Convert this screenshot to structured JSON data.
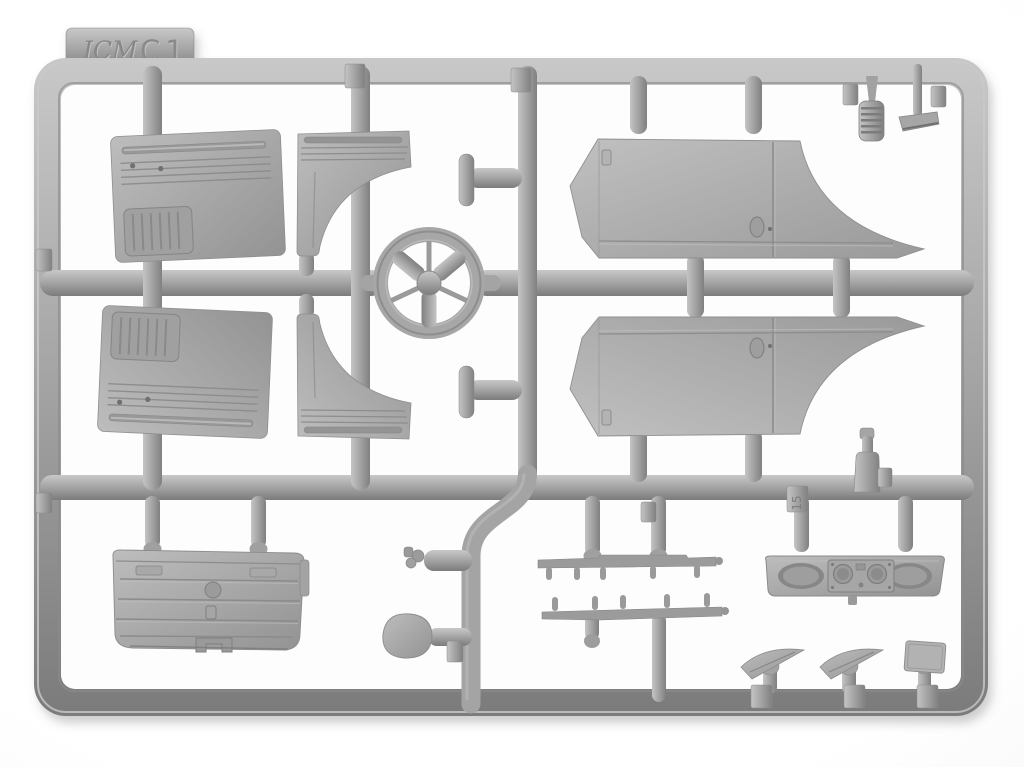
{
  "image": {
    "kind": "photograph",
    "subject": "Injection-molded gray styrene sprue (parts frame) from an ICM scale model kit, photographed on a white background"
  },
  "sprue": {
    "brand": "ICM",
    "code": "C1",
    "tab_number_15": "15",
    "colors": {
      "plastic_base": "#a7a7a7",
      "plastic_light": "#c8c8c8",
      "plastic_dark": "#7b7b7b",
      "background": "#ffffff"
    },
    "parts": [
      {
        "name": "door-inner-panel-upper",
        "appearance": "rectangular panel, horizontal ribs, louvered pocket, two small holes"
      },
      {
        "name": "door-inner-panel-lower",
        "appearance": "mirrored copy of the upper door panel"
      },
      {
        "name": "quarter-panel-upper",
        "appearance": "ribbed bracket with concave wheel-arch cutout"
      },
      {
        "name": "quarter-panel-lower",
        "appearance": "mirrored copy of the upper quarter panel"
      },
      {
        "name": "steering-wheel",
        "appearance": "three thick spokes and three thin spokes around a round hub"
      },
      {
        "name": "cab-side-panel-upper",
        "appearance": "long body side with pointed nose, door seam, oval handle recess and swept wheel-arch tail"
      },
      {
        "name": "cab-side-panel-lower",
        "appearance": "mirrored copy of the upper body side panel"
      },
      {
        "name": "rear-cab-panel",
        "appearance": "wide ribbed panel with filler cap, latch and bracket details"
      },
      {
        "name": "dashboard",
        "appearance": "instrument panel with two oval bezels and twin round gauges"
      },
      {
        "name": "hinge-rail-upper",
        "appearance": "thin stepped rail with five pegs"
      },
      {
        "name": "hinge-rail-lower",
        "appearance": "thin stepped rail with five pegs"
      },
      {
        "name": "rear-view-mirror",
        "appearance": "oval paddle mirror on a short arm"
      },
      {
        "name": "horn",
        "appearance": "small cylinder with detailed tip"
      },
      {
        "name": "hand-lever-upper",
        "appearance": "T-shaped lever"
      },
      {
        "name": "hand-lever-lower",
        "appearance": "T-shaped lever"
      },
      {
        "name": "gear-lever-base",
        "appearance": "bottle-shaped boot with cap"
      },
      {
        "name": "spring",
        "appearance": "ribbed coil spring"
      },
      {
        "name": "pedal",
        "appearance": "flat blade on a stem"
      },
      {
        "name": "wiper-blade-left",
        "appearance": "slender tapered blade on ball stub"
      },
      {
        "name": "wiper-blade-right",
        "appearance": "slender tapered blade on ball stub"
      },
      {
        "name": "small-plate",
        "appearance": "small tilted rectangular plate on ball stub"
      }
    ]
  }
}
